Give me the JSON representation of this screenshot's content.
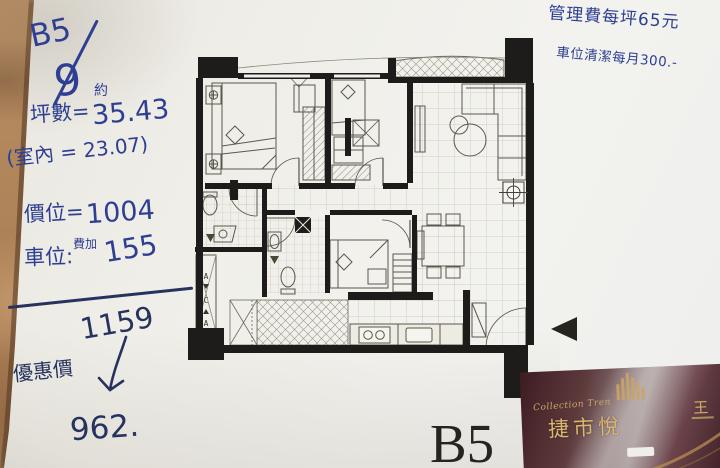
{
  "colors": {
    "ink": "#2e3f93",
    "ink_dark": "#27335f",
    "paper": "#f0efea",
    "table": "#b3885f",
    "plan_wall": "#1d1c1a",
    "card_background": "#4a2028",
    "card_gold": "#cfa968"
  },
  "notes_left": {
    "unit_code": "B5",
    "unit_floor": "9",
    "approx_mark": "約",
    "area_label": "坪數=",
    "area_value": "35.43",
    "indoor_area": "(室內 = 23.07)",
    "price_label": "價位=",
    "price_value": "1004",
    "parking_label": "車位:",
    "parking_note": "費加",
    "parking_value": "155",
    "total_value": "1159",
    "discount_label": "優惠價",
    "discount_value": "962."
  },
  "notes_top_right": {
    "line1": "管理費每坪65元",
    "line2": "車位清潔每月300.-"
  },
  "floor_plan": {
    "unit_label": "B5",
    "shaft_letters": [
      "A",
      "C",
      "A"
    ]
  },
  "brochure_card": {
    "collection_text": "Collection Tren",
    "property_name": "捷市悅",
    "agent_surname": "王"
  }
}
